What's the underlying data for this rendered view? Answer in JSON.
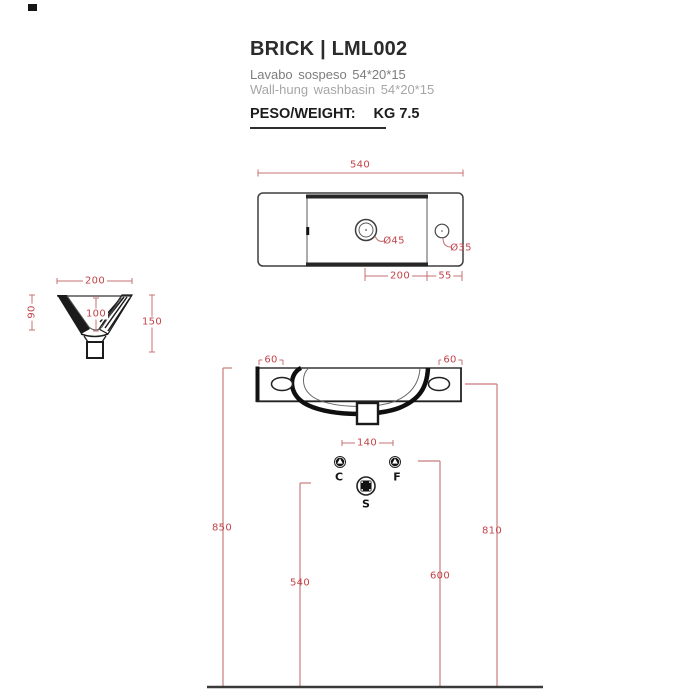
{
  "header": {
    "title": "BRICK | LML002",
    "subtitle_it": "Lavabo sospeso 54*20*15",
    "subtitle_en": "Wall-hung washbasin 54*20*15",
    "weight_label": "PESO/WEIGHT:",
    "weight_value": "KG 7.5"
  },
  "top_view": {
    "width_dim": "540",
    "drain_diameter": "Ø45",
    "tap_hole_diameter": "Ø35",
    "drain_to_edge_dim": "200",
    "edge_dim": "55"
  },
  "side_view": {
    "depth_dim": "200",
    "back_height_dim": "90",
    "inner_depth_dim": "100",
    "height_dim": "150"
  },
  "front_view": {
    "left_hole_offset_dim": "60",
    "right_hole_offset_dim": "60",
    "tap_spacing_dim": "140"
  },
  "install": {
    "hot_water_label": "C",
    "cold_water_label": "F",
    "drain_label": "S",
    "basin_top_height_dim": "850",
    "drain_height_dim": "540",
    "supply_height_dim": "600",
    "fixing_holes_height_dim": "810"
  },
  "colors": {
    "dimension_line": "#c47172",
    "dimension_text": "#c2434a",
    "drawing_line": "#3f3f3f",
    "drawing_bold": "#141414"
  }
}
